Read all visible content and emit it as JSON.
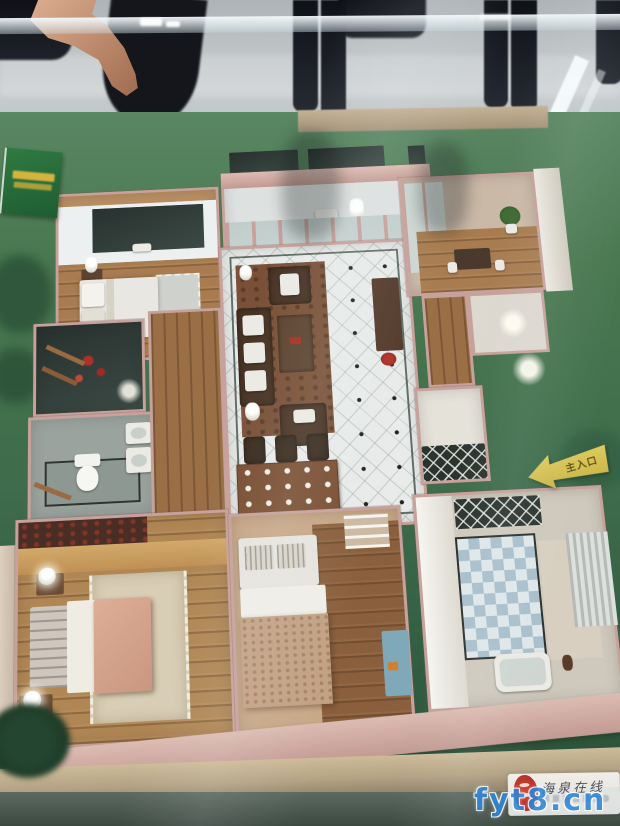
{
  "scene": {
    "setting": "Apartment floor-plan scale model inside a glass display case, photographed from above; visitors' legs and a pointing hand are visible behind the glass",
    "entrance_sign_label": "主入口",
    "watermark": {
      "site_name": "海泉在线",
      "url": "fyt8.cn"
    },
    "colors": {
      "base_green": "#3f6b4a",
      "wall_pink": "#c7a19b",
      "tile_white": "#e8ebe9",
      "wood_floor": "#a87c50",
      "rug_brown": "#7a5138",
      "checker_blue": "#a9bfcc",
      "arrow_yellow": "#d6c254",
      "watermark_blue": "#2f86d8",
      "seal_red": "#c03028"
    }
  }
}
